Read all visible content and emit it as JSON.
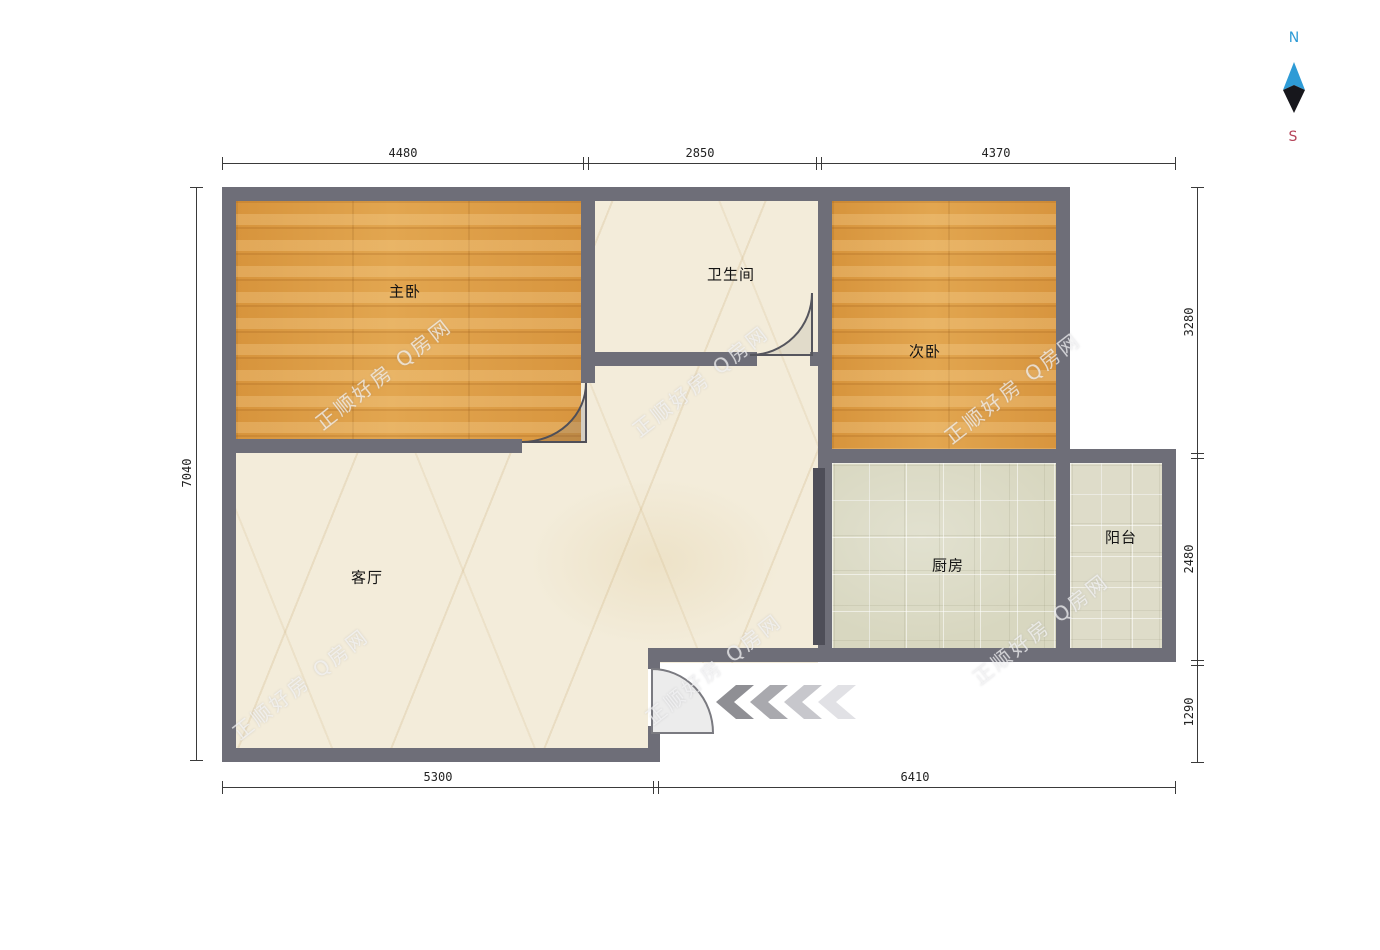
{
  "compass": {
    "north": "N",
    "south": "S"
  },
  "rooms": {
    "master_bedroom": "主卧",
    "bathroom": "卫生间",
    "second_bedroom": "次卧",
    "living_room": "客厅",
    "kitchen": "厨房",
    "balcony": "阳台"
  },
  "dimensions": {
    "top": [
      "4480",
      "2850",
      "4370"
    ],
    "bottom": [
      "5300",
      "6410"
    ],
    "left": [
      "7040"
    ],
    "right": [
      "3280",
      "2480",
      "1290"
    ]
  },
  "watermark": "正顺好房 Q房网",
  "colors": {
    "wall": "#6e6e78",
    "wood_floor": "#db9a45",
    "marble_floor": "#f3ecda",
    "tile_floor": "#d8d7c0",
    "north_label": "#2e9bd6",
    "south_label": "#b5455a"
  }
}
